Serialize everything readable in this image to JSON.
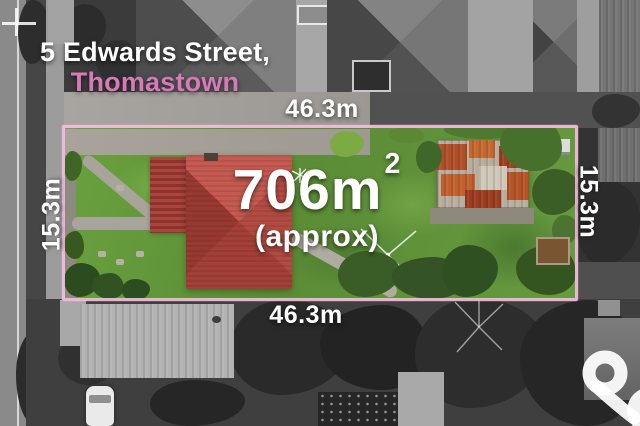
{
  "photo": {
    "address": {
      "line1": "5 Edwards Street,",
      "line2": "Thomastown"
    },
    "lot": {
      "area_value": "706m",
      "area_exponent": "2",
      "area_qualifier": "(approx)",
      "width_top": "46.3m",
      "width_bottom": "46.3m",
      "depth_left": "15.3m",
      "depth_right": "15.3m"
    },
    "branding": {
      "logo_icon": "ampersand-logo-icon"
    },
    "colors": {
      "boundary_pink": "#f3bedd",
      "suburb_pink": "#d67ab9",
      "label_white": "#ffffff",
      "house_roof_red": "#b24c42",
      "lawn_green": "#649a3c",
      "shed_rust": "#b0502a"
    }
  }
}
